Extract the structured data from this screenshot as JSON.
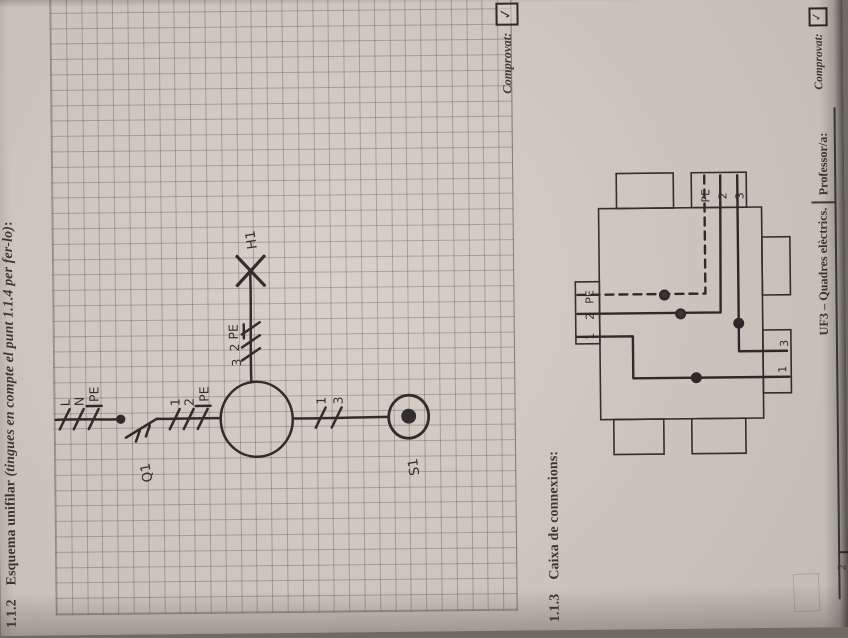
{
  "sections": {
    "s112": {
      "number": "1.1.2",
      "heading": "Esquema unifilar ",
      "note_italic": "(tingues en compte el punt 1.1.4 per fer-lo)",
      "suffix": ":"
    },
    "s113": {
      "number": "1.1.3",
      "heading": "Caixa de connexions:"
    }
  },
  "comprovat_top": {
    "label": "Comprovat:",
    "check": "✓"
  },
  "comprovat_bottom": {
    "label": "Comprovat:",
    "check": "✓"
  },
  "schematic": {
    "incoming": [
      "L",
      "N",
      "PE"
    ],
    "after_q1": [
      "1",
      "2",
      "PE"
    ],
    "lamp_branch": [
      "3",
      "2",
      "PE"
    ],
    "switch_branch": [
      "1",
      "3"
    ],
    "devices": {
      "q1": "Q1",
      "h1": "H1",
      "s1": "S1"
    }
  },
  "junction_box": {
    "top_gland": [
      "1",
      "2",
      "PE"
    ],
    "right_gland": [
      "PE",
      "2",
      "3"
    ],
    "bottom_exits": [
      "1",
      "3"
    ]
  },
  "footer": {
    "course": "UF3 – Quadres elèctrics.",
    "professor": "Professor/a:",
    "page": "2"
  },
  "colors": {
    "paper": "#d4cec6",
    "ink": "#262320",
    "grid_line": "#706a61"
  }
}
